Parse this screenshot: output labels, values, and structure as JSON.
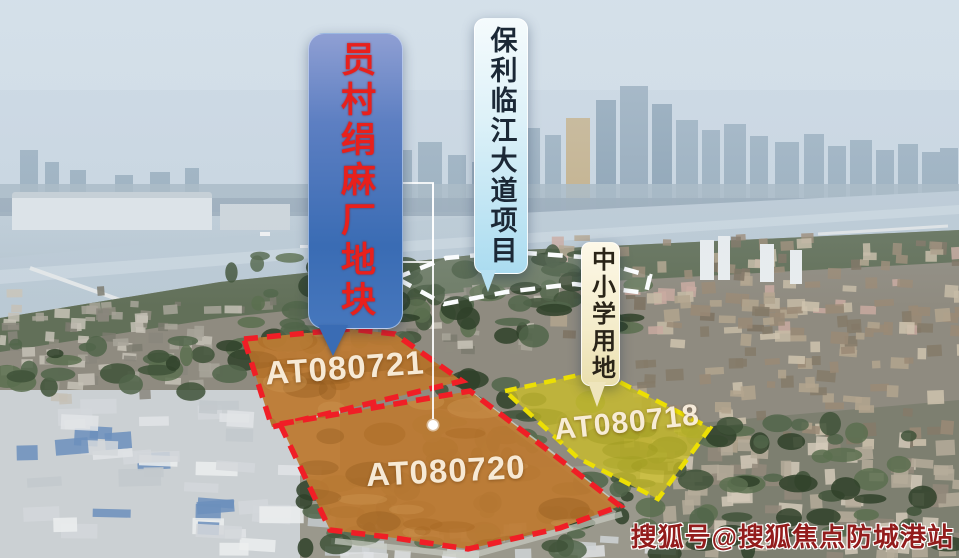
{
  "callouts": {
    "factory_site": {
      "label": "员村绢麻厂地块",
      "text_color": "#e8201c",
      "bubble_color": "#3a6cb4"
    },
    "poly_project": {
      "label": "保利临江大道项目",
      "text_color": "#1b2836",
      "bubble_color": "#abdcf0"
    },
    "school_land": {
      "label": "中小学用地",
      "text_color": "#2a2418",
      "bubble_color": "#f4ecca"
    }
  },
  "parcels": [
    {
      "code": "AT080721",
      "outline_color": "#f01e26"
    },
    {
      "code": "AT080720",
      "outline_color": "#f01e26"
    },
    {
      "code": "AT080718",
      "outline_color": "#ecdf04"
    }
  ],
  "watermark": {
    "text": "搜狐号@搜狐焦点防城港站",
    "color": "#931c1c"
  }
}
